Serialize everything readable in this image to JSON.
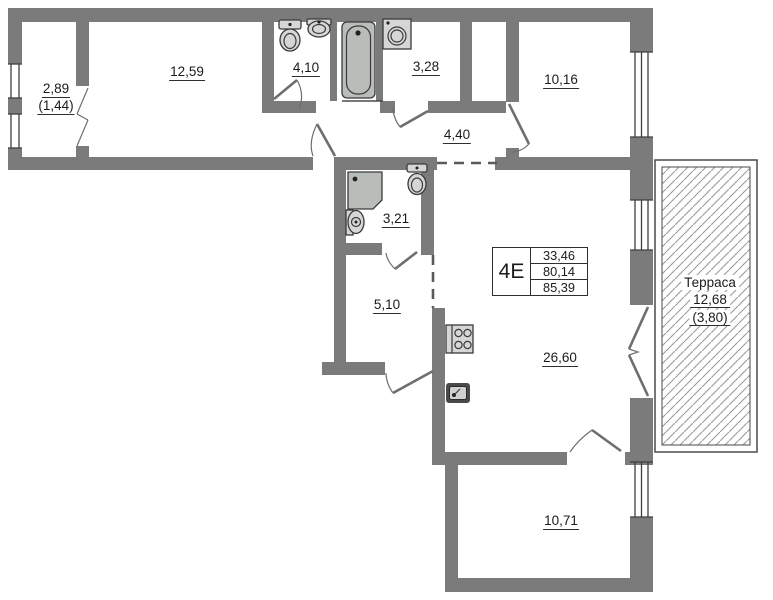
{
  "plan": {
    "labels": {
      "balcony_area": "2,89",
      "balcony_area_reduced": "(1,44)",
      "room_12_59": "12,59",
      "bath_4_10": "4,10",
      "room_3_28": "3,28",
      "hall_4_40": "4,40",
      "room_10_16": "10,16",
      "bath_3_21": "3,21",
      "hall_5_10": "5,10",
      "living_26_60": "26,60",
      "room_10_71": "10,71"
    },
    "terrace": {
      "name": "Терраса",
      "area": "12,68",
      "area_reduced": "(3,80)"
    },
    "info_table": {
      "type": "4Е",
      "rows": [
        "33,46",
        "80,14",
        "85,39"
      ]
    },
    "fixtures": [
      "toilet",
      "sink",
      "bathtub",
      "washing-machine",
      "shower-cabin",
      "toilet",
      "sink",
      "stove",
      "kitchen-sink"
    ],
    "colors": {
      "wall": "#7b7b7b",
      "line": "#4a4a4a",
      "text": "#1b1b1b"
    }
  }
}
